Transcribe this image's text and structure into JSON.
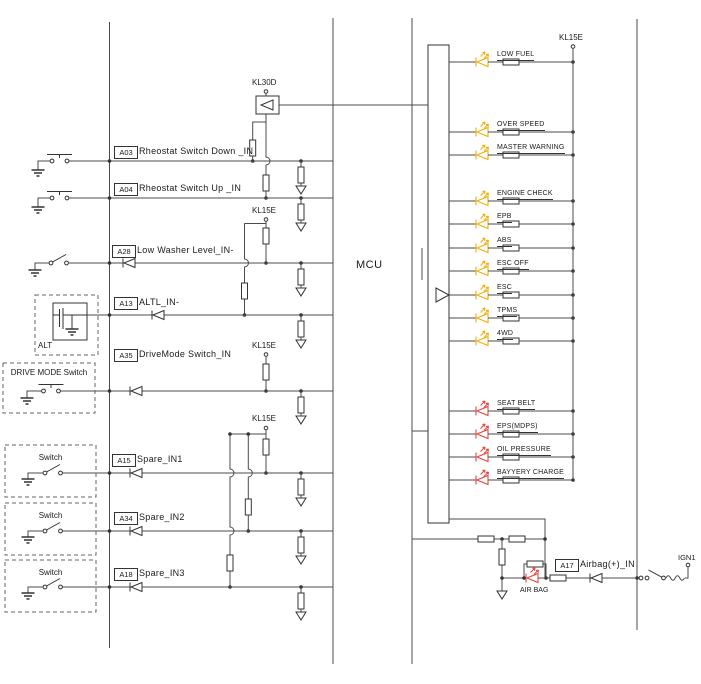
{
  "colors": {
    "wire": "#4b4b4b",
    "symbol": "#333333",
    "led-yellow": "#F2AE0E",
    "led-red": "#E8473F",
    "text": "#1a1a1a"
  },
  "mcu": {
    "label": "MCU"
  },
  "power_rails": {
    "kl30d": "KL30D",
    "kl15e": "KL15E",
    "ign1": "IGN1"
  },
  "inputs": [
    {
      "pin": "A03",
      "label": "Rheostat Switch Down _IN"
    },
    {
      "pin": "A04",
      "label": "Rheostat Switch Up _IN"
    },
    {
      "pin": "A28",
      "label": "Low Washer Level_IN-"
    },
    {
      "pin": "A13",
      "label": "ALTL_IN-"
    },
    {
      "pin": "A35",
      "label": "DriveMode Switch_IN"
    },
    {
      "pin": "A15",
      "label": "Spare_IN1"
    },
    {
      "pin": "A34",
      "label": "Spare_IN2"
    },
    {
      "pin": "A18",
      "label": "Spare_IN3"
    },
    {
      "pin": "A17",
      "label": "Airbag(+)_IN"
    }
  ],
  "sources": {
    "alt": "ALT",
    "drive_mode": "DRIVE MODE Switch",
    "spare": "Switch"
  },
  "indicators": {
    "yellow": [
      "LOW FUEL",
      "OVER SPEED",
      "MASTER WARNING",
      "ENGINE CHECK",
      "EPB",
      "ABS",
      "ESC OFF",
      "ESC",
      "TPMS",
      "4WD"
    ],
    "red": [
      "SEAT BELT",
      "EPS(MDPS)",
      "OIL PRESSURE",
      "BAYYERY CHARGE"
    ],
    "airbag_lamp": "AIR BAG"
  }
}
